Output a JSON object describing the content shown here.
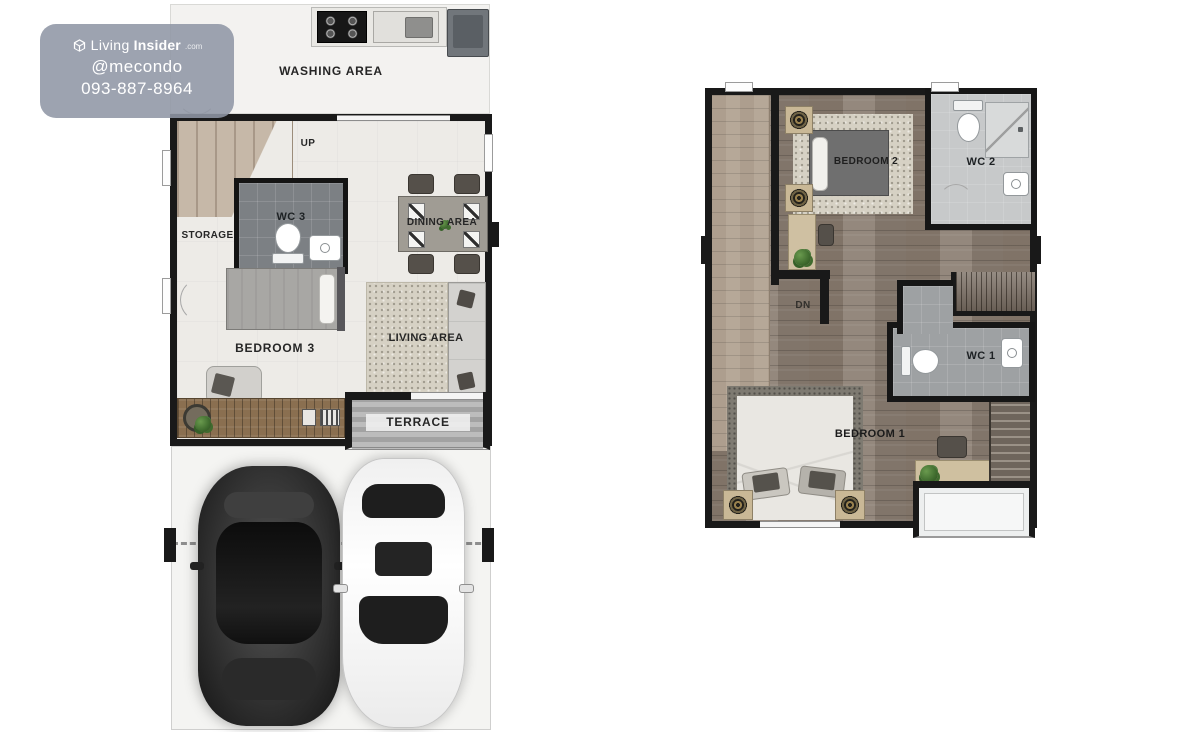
{
  "watermark": {
    "brand_light": "Living",
    "brand_bold": "Insider",
    "brand_suffix": ".com",
    "handle": "@mecondo",
    "phone": "093-887-8964"
  },
  "first_floor": {
    "labels": {
      "washing": "WASHING AREA",
      "up": "UP",
      "storage": "STORAGE",
      "wc3": "WC 3",
      "dining": "DINING AREA",
      "bedroom3": "BEDROOM 3",
      "living": "LIVING AREA",
      "terrace": "TERRACE"
    }
  },
  "second_floor": {
    "labels": {
      "bedroom2": "BEDROOM 2",
      "wc2": "WC 2",
      "dn": "DN",
      "wc1": "WC 1",
      "bedroom1": "BEDROOM 1"
    }
  },
  "colors": {
    "wall": "#191919",
    "wood_floor": "#8c7f73",
    "light_wood": "#b6a898",
    "interior_floor": "#edebe7",
    "terrace_gray": "#a9a9a9",
    "watermark_bg": "#8f96a5"
  }
}
